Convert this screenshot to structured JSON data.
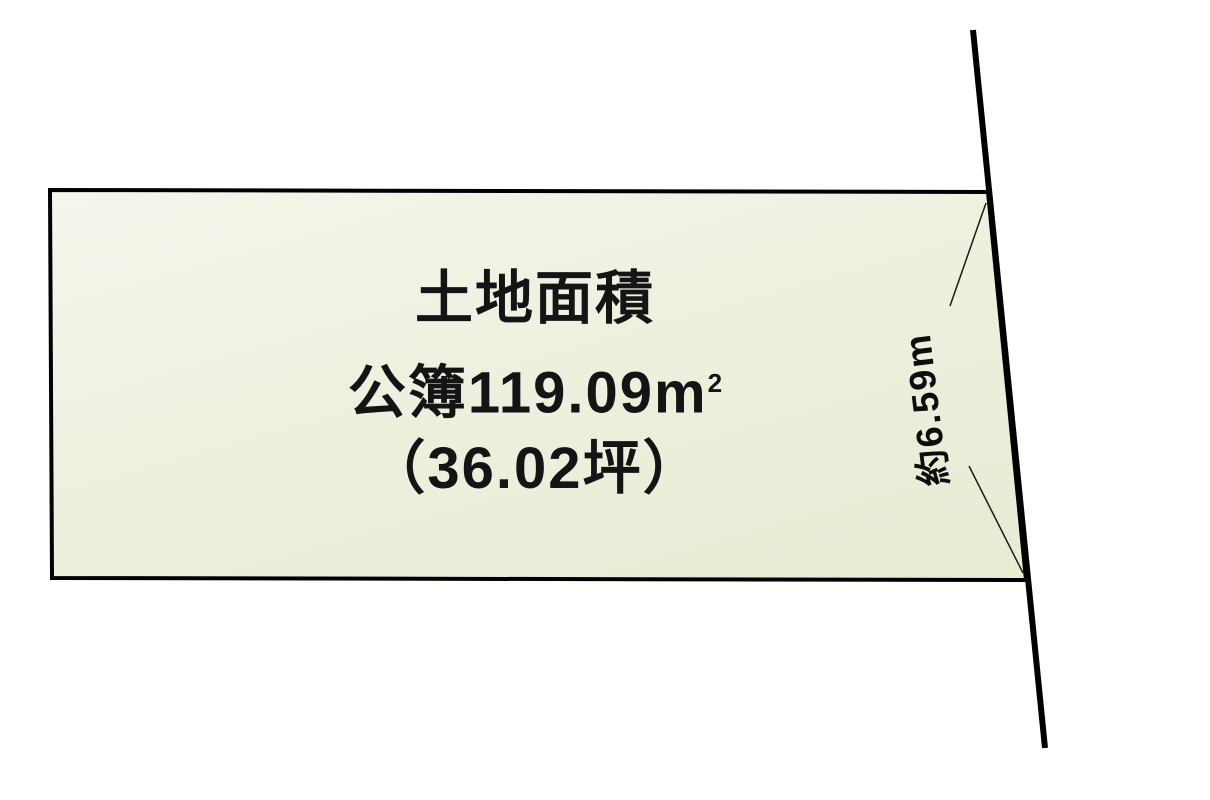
{
  "plan": {
    "parcel_label": {
      "title": "土地面積",
      "area_registered": "公簿119.09m",
      "area_unit_superscript": "2",
      "area_tsubo": "（36.02坪）"
    },
    "dimension_right_edge": "約6.59m"
  },
  "colors": {
    "page_background": "#ffffff",
    "parcel_fill_top": "#f3f6eb",
    "parcel_fill_bottom": "#e7edd5",
    "outline": "#000000",
    "leader_line": "#1a1a1a",
    "text": "#141414"
  }
}
